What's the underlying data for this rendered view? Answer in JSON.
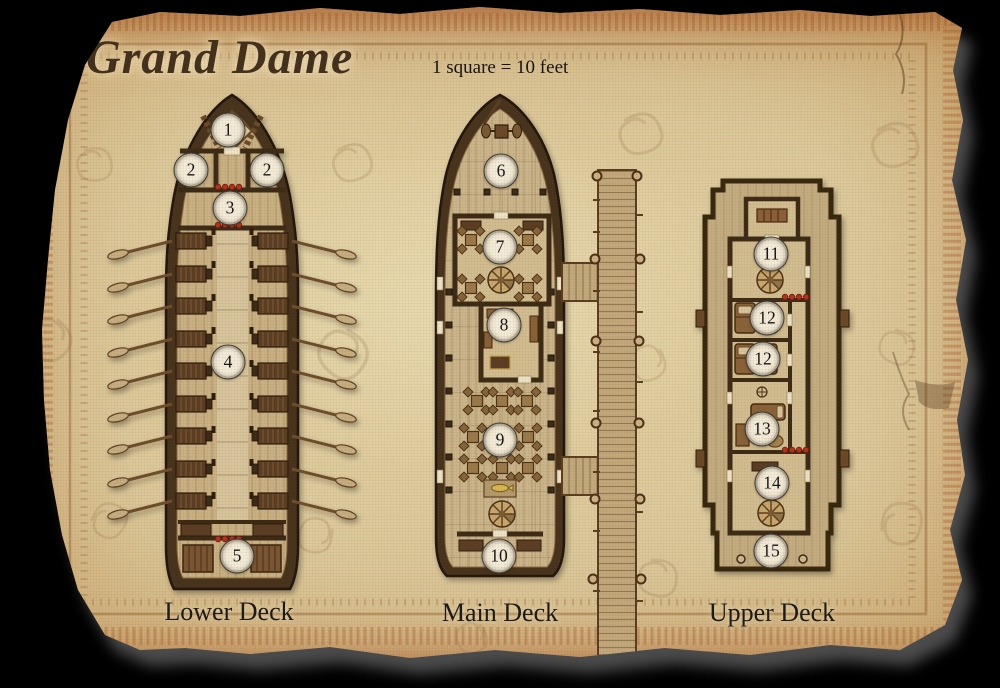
{
  "title": "Grand Dame",
  "scale_note": "1 square = 10 feet",
  "decks": [
    {
      "label": "Lower Deck"
    },
    {
      "label": "Main Deck"
    },
    {
      "label": "Upper Deck"
    }
  ],
  "markers": {
    "lower": [
      {
        "label": "1"
      },
      {
        "label": "2"
      },
      {
        "label": "2"
      },
      {
        "label": "3"
      },
      {
        "label": "4"
      },
      {
        "label": "5"
      }
    ],
    "main": [
      {
        "label": "6"
      },
      {
        "label": "7"
      },
      {
        "label": "8"
      },
      {
        "label": "9"
      },
      {
        "label": "10"
      }
    ],
    "upper": [
      {
        "label": "11"
      },
      {
        "label": "12"
      },
      {
        "label": "12"
      },
      {
        "label": "13"
      },
      {
        "label": "14"
      },
      {
        "label": "15"
      }
    ]
  },
  "colors": {
    "background": "#000000",
    "parchment": "#d6c094",
    "parchment_edge": "#ad6a2f",
    "hull_wood": "#46321c",
    "deck_wood": "#c9b183",
    "marker_fill": "#f3ecd9",
    "bead_red": "#b5301c",
    "title_ink": "#42301d",
    "label_ink": "#191919"
  }
}
